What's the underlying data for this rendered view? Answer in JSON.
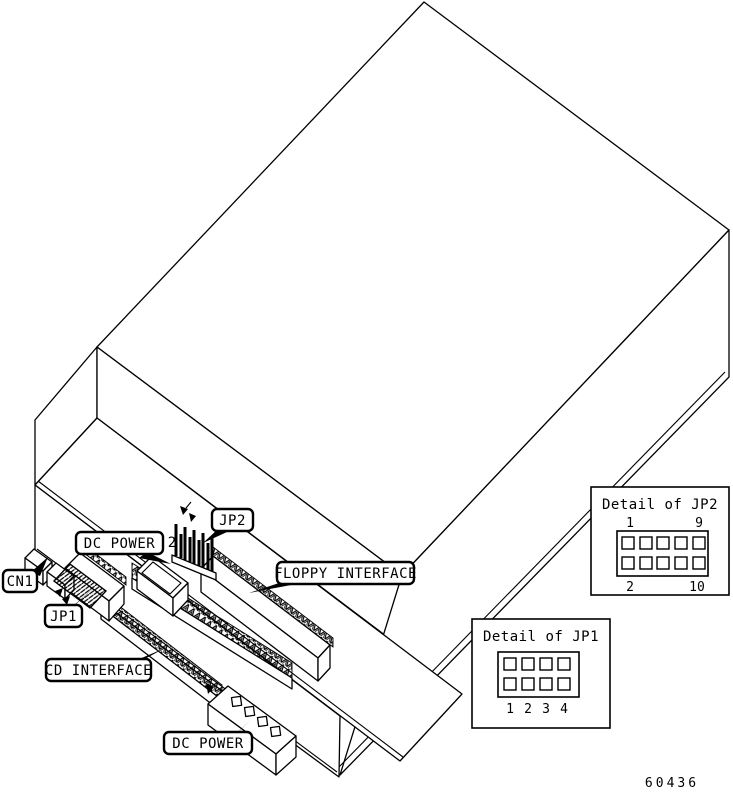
{
  "figure": {
    "callouts": {
      "cn1": "CN1",
      "jp1": "JP1",
      "jp2": "JP2",
      "dc_power_top": "DC POWER",
      "dc_power_bottom": "DC POWER",
      "floppy_interface": "FLOPPY INTERFACE",
      "cd_interface": "CD INTERFACE"
    },
    "jp2_pin2_annotation": "2",
    "detail_jp2": {
      "title": "Detail of JP2",
      "pin_top_left": "1",
      "pin_top_right": "9",
      "pin_bottom_left": "2",
      "pin_bottom_right": "10"
    },
    "detail_jp1": {
      "title": "Detail of JP1",
      "pin_labels": [
        "1",
        "2",
        "3",
        "4"
      ]
    },
    "figure_number": "60436",
    "colors": {
      "line": "#000000",
      "background": "#ffffff"
    }
  }
}
